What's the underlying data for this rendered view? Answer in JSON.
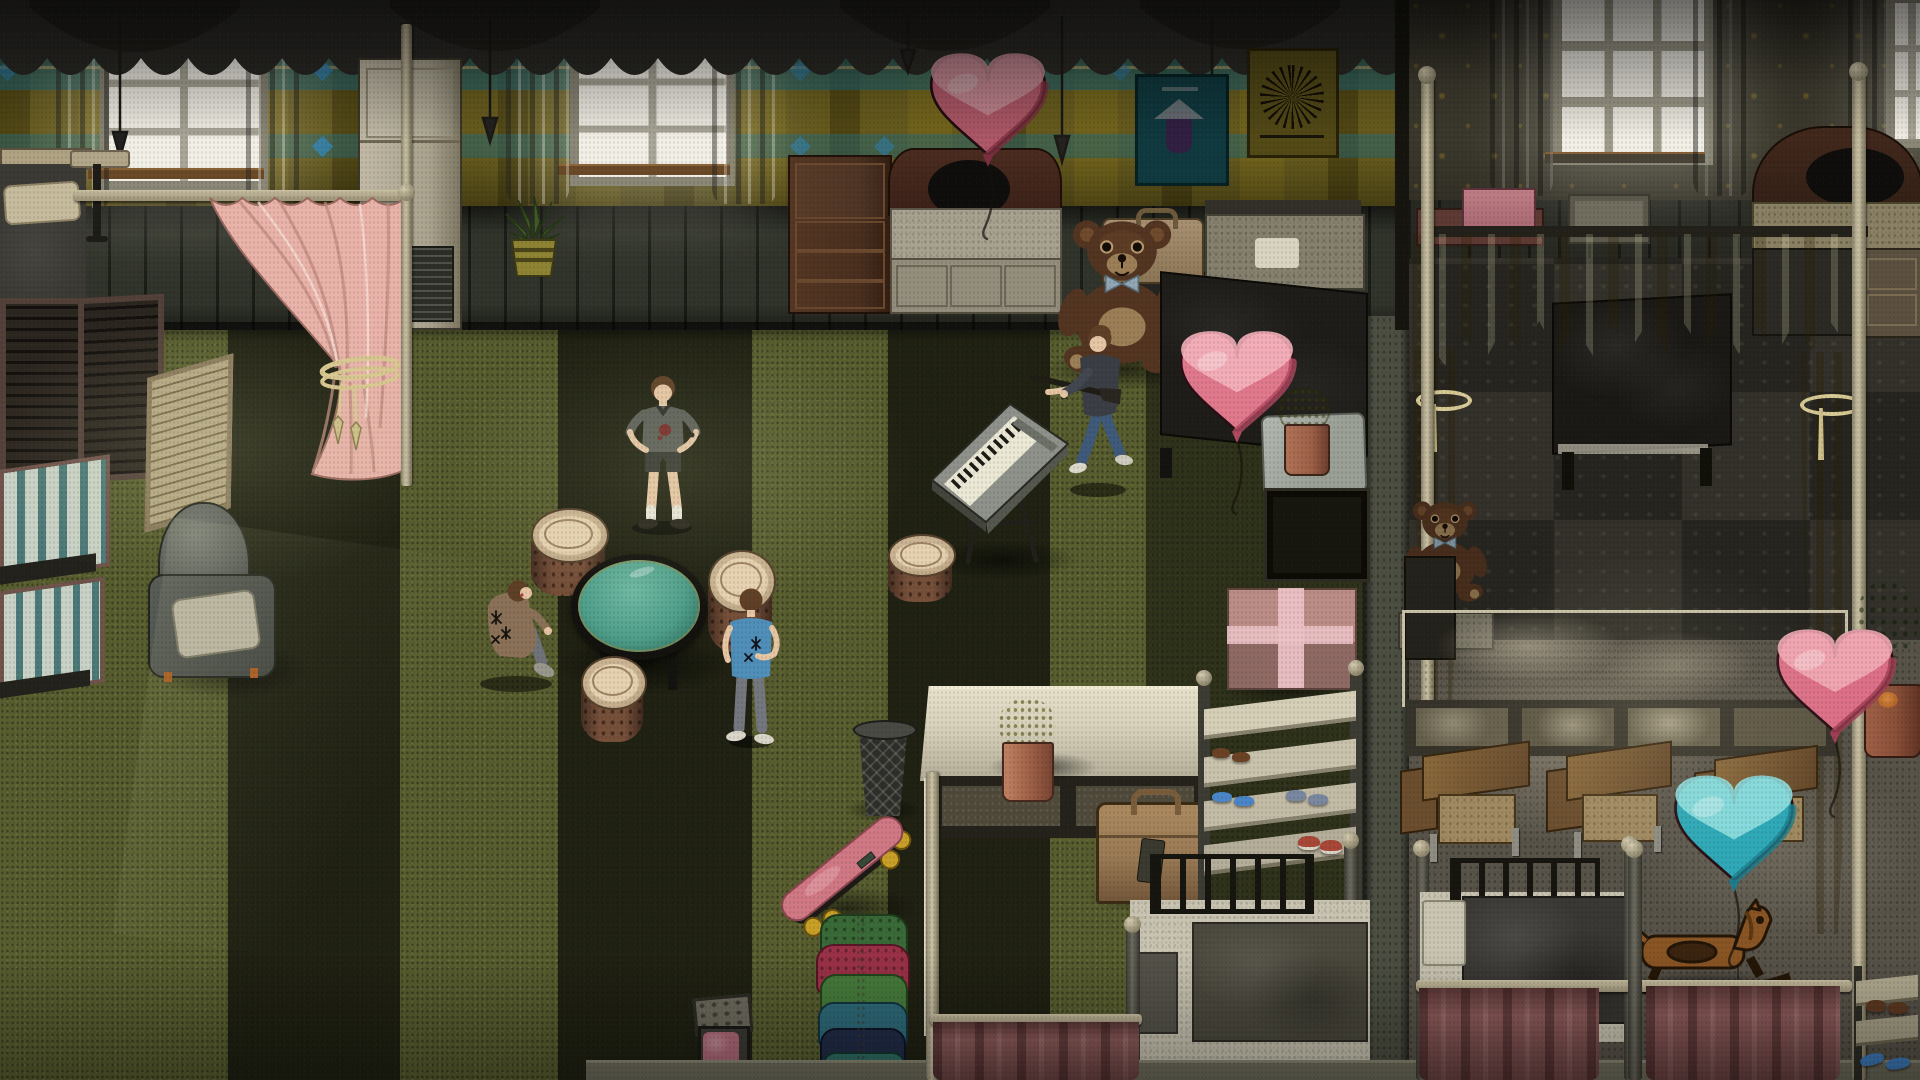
{
  "scene": {
    "view": "isometric interior of a two-room dormitory, dim daylight from windows",
    "text_on_screen": [],
    "characters": [
      {
        "id": "teen-standing",
        "pose": "standing, hands on hips",
        "top": "grey tee with blood stain",
        "bottom": "dark shorts, white socks"
      },
      {
        "id": "teen-crouching",
        "pose": "crouched by table",
        "top": "tan jacket with black star marks",
        "bottom": "grey pants"
      },
      {
        "id": "teen-blue-shirt",
        "pose": "standing, back turned",
        "top": "blue tee with black star print",
        "bottom": "grey jeans, white shoes"
      },
      {
        "id": "man-with-rifle",
        "pose": "walking, carrying rifle",
        "top": "dark grey shirt",
        "bottom": "blue jeans, white shoes"
      }
    ],
    "left_room_objects": [
      "window",
      "grey-curtains",
      "dark-valance",
      "pink-tieback-curtain",
      "air-conditioner",
      "aloe-potted-plant",
      "chest-of-drawers",
      "white-dresser",
      "bed-with-dark-headboard",
      "pink-heart-balloon",
      "teal-poster",
      "yellow-poster",
      "giant-teddy-bear",
      "wall-suitcase",
      "white-bed",
      "dark-bed",
      "nightstand-with-yellow-plant",
      "black-cabinet",
      "pink-gift-box",
      "round-glass-table",
      "tree-stump-stools",
      "electronic-keyboard",
      "wire-trash-can",
      "long-white-table",
      "yellow-potted-plant",
      "leather-suitcase",
      "shoe-rack-with-shoes",
      "metal-bed",
      "skateboard",
      "clothes-rack",
      "toy-box",
      "mauve-privacy-curtain",
      "armchair",
      "folding-screens",
      "striped-mattresses",
      "corner-bed",
      "side-table"
    ],
    "right_room_objects": [
      "window",
      "yellow-canopy-with-tassels",
      "canopy-bed",
      "small-teddy-bear",
      "arched-headboard",
      "dresser",
      "pink-box-on-shelf",
      "long-counter",
      "school-desks",
      "school-chairs",
      "pink-heart-balloon",
      "teal-heart-balloon",
      "green-bush-pot",
      "terracotta-pot",
      "metal-bed",
      "mauve-privacy-curtains",
      "rocking-horse",
      "shoe-rack-with-shoes"
    ]
  },
  "palette": {
    "wall_plaid": "#7d6f24",
    "wall_teal": "#2f7880",
    "wall_blue": "#2d7fae",
    "wainscot": "#31342b",
    "right_wall": "#474436",
    "right_wall_motif": "#ac8e34",
    "floor_green": "#5a5f30",
    "floor_stripe": "#17180f",
    "right_carpet_a": "#262520",
    "right_carpet_b": "#33312a",
    "right_floor": "#59544a",
    "valance": "#2b2a26",
    "window_glow": "#f2efe6",
    "window_frame": "#8c8878",
    "curtain_grey": "#8f8e86",
    "curtain_pink": "#e9b3a9",
    "rope_gold": "#d9c892",
    "canopy_yellow": "#ad9b2d",
    "curtain_mauve": "#925f5e",
    "heart_pink_base": "#d96e82",
    "heart_pink_light": "#f2abb6",
    "heart_pink_dark": "#9e3c50",
    "heart_teal_base": "#2fa9b8",
    "heart_teal_light": "#8fdfe0",
    "heart_teal_dark": "#1d7f8e",
    "stump_top": "#d9c5a3",
    "stump_side": "#77503a",
    "table_glass": "#4f9f8b",
    "teddy": "#5a3a24",
    "teddy_light": "#7a5231",
    "teddy_belly": "#aa8a5e",
    "skin": "#e6c6a5",
    "hair": "#5f4026",
    "shirt_blue": "#4f8fba",
    "jeans": "#3f5a7a",
    "jacket_tan": "#8a7158",
    "skate_pink": "#d07984",
    "wheel_yellow": "#c8a028",
    "plant_yellow": "#b1ad22",
    "pot_clay": "#9e6047",
    "gift_pink": "#bb8d86",
    "ribbon_pink": "#ecc2c6",
    "suitcase_tan": "#9a7a55",
    "counter_top": "#8e8773",
    "desk_wood": "#7c5c35",
    "horse_wood": "#8a5524",
    "white_table": "#d8d2bc",
    "baseboard": "#6f6d5c",
    "linen": "#c9c4b2",
    "blanket": "#4c4a3e"
  }
}
